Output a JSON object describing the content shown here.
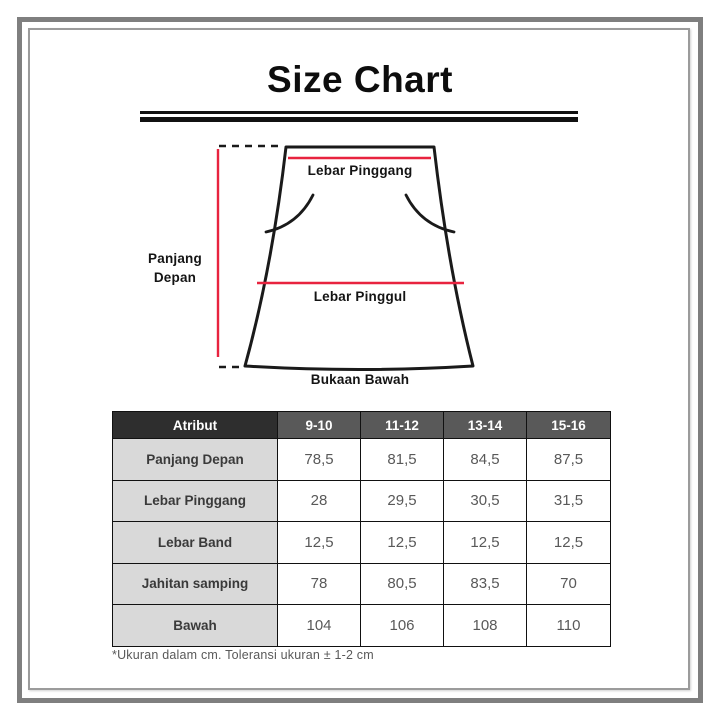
{
  "title": "Size Chart",
  "colors": {
    "accent_red": "#e8233f",
    "line_black": "#1a1a1a",
    "frame_outer_gray": "#7f7f7f",
    "frame_inner_gray": "#9b9b9b",
    "header_attr_bg": "#2e2e2e",
    "header_size_bg": "#595959",
    "attr_cell_bg": "#d9d9d9",
    "value_text": "#595959",
    "header_text": "#ffffff"
  },
  "diagram": {
    "labels": {
      "waist": "Lebar Pinggang",
      "hip": "Lebar Pinggul",
      "bottom": "Bukaan Bawah",
      "front_length_line1": "Panjang",
      "front_length_line2": "Depan"
    }
  },
  "table": {
    "header": [
      "Atribut",
      "9-10",
      "11-12",
      "13-14",
      "15-16"
    ],
    "rows": [
      {
        "label": "Panjang Depan",
        "values": [
          "78,5",
          "81,5",
          "84,5",
          "87,5"
        ]
      },
      {
        "label": "Lebar Pinggang",
        "values": [
          "28",
          "29,5",
          "30,5",
          "31,5"
        ]
      },
      {
        "label": "Lebar Band",
        "values": [
          "12,5",
          "12,5",
          "12,5",
          "12,5"
        ]
      },
      {
        "label": "Jahitan samping",
        "values": [
          "78",
          "80,5",
          "83,5",
          "70"
        ]
      },
      {
        "label": "Bawah",
        "values": [
          "104",
          "106",
          "108",
          "110"
        ]
      }
    ],
    "footnote": "*Ukuran dalam cm. Toleransi ukuran ± 1-2 cm"
  }
}
